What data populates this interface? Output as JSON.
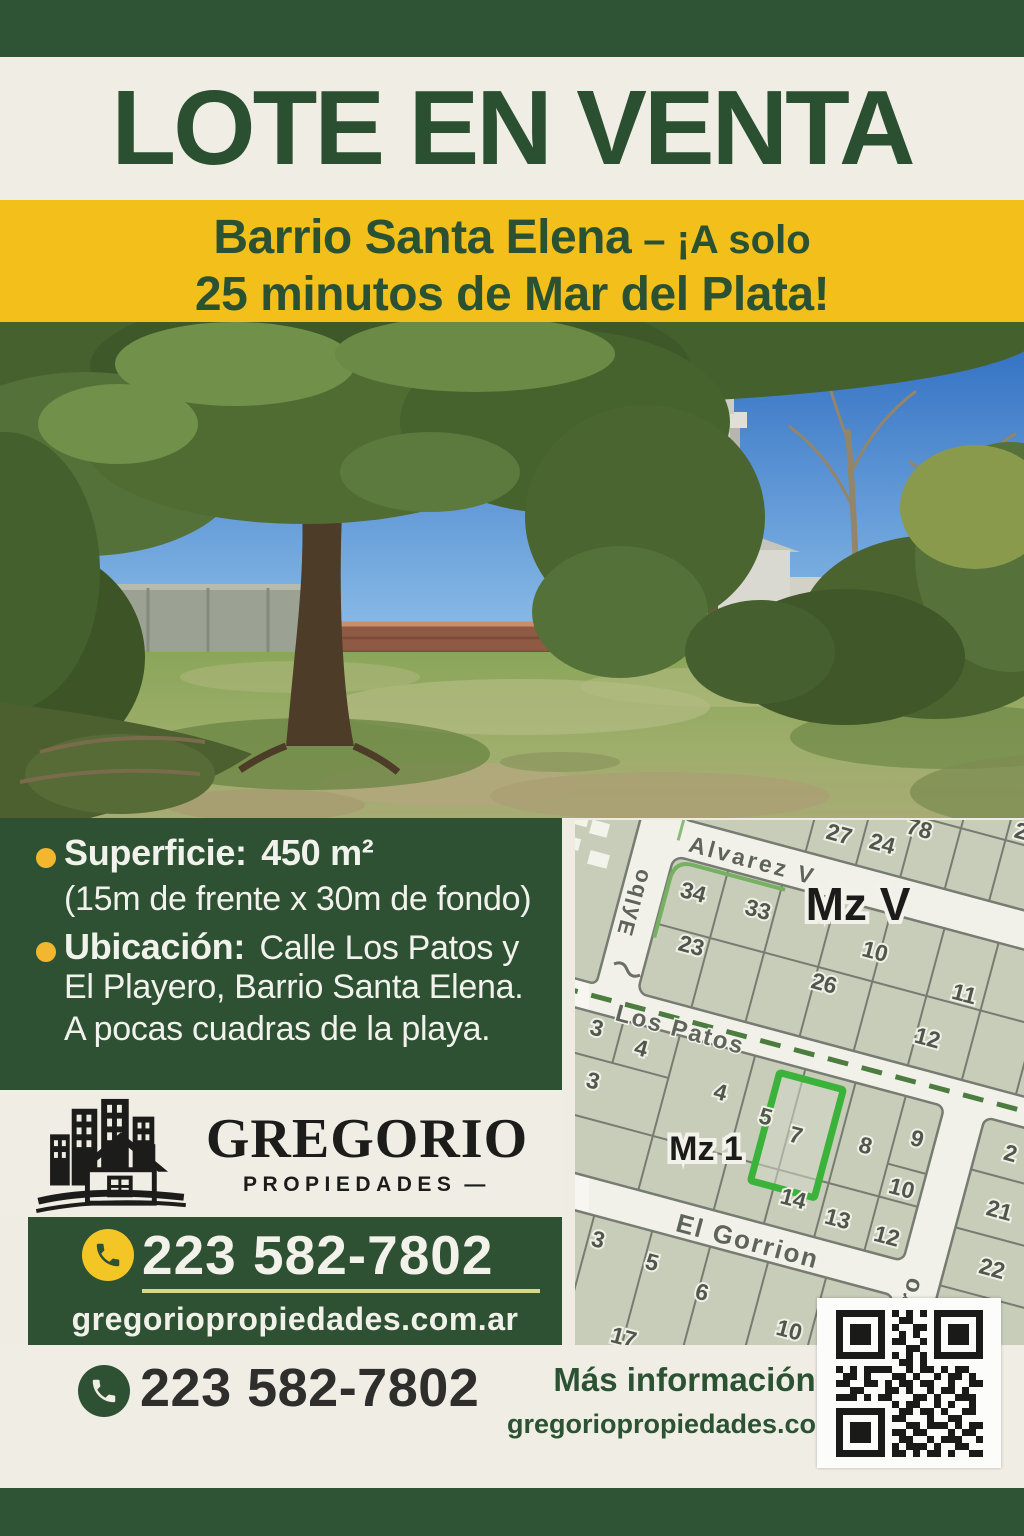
{
  "poster": {
    "title": "LOTE EN VENTA",
    "subtitle_strong": "Barrio Santa Elena",
    "subtitle_rest": "– ¡A solo",
    "subtitle_line2": "25 minutos de Mar del Plata!"
  },
  "details": {
    "surface_label": "Superficie:",
    "surface_value": "450 m²",
    "surface_note": "(15m de frente x 30m de fondo)",
    "location_label": "Ubicación:",
    "location_line1": "Calle Los Patos y",
    "location_line2": "El Playero, Barrio Santa Elena.",
    "location_line3": "A pocas cuadras de la playa."
  },
  "brand": {
    "name": "GREGORIO",
    "tagline": "PROPIEDADES",
    "tagline_dash": "—"
  },
  "contact": {
    "phone": "223 582-7802",
    "website": "gregoriopropiedades.com.ar",
    "more_info_label": "Más información:"
  },
  "map": {
    "block_labels": {
      "mz_v": "Mz V",
      "mz_1": "Mz 1"
    },
    "streets": {
      "alvarez": "Alvarez V",
      "los_patos": "Los Patos",
      "el_gorrion": "El Gorrion",
      "playero": "Playero",
      "left_street": "Ǝʎlbo"
    },
    "highlighted_lot": "7",
    "lots": {
      "n78": "78",
      "n27": "27",
      "n24": "24",
      "n2a": "2",
      "n34": "34",
      "n33": "33",
      "n23": "23",
      "n26": "26",
      "n10a": "10",
      "n11": "11",
      "n12a": "12",
      "n3a": "3",
      "n4a": "4",
      "n3b": "3",
      "n4b": "4",
      "n5a": "5",
      "n7": "7",
      "n8": "8",
      "n9": "9",
      "n14": "14",
      "n13": "13",
      "n12b": "12",
      "n10b": "10",
      "n2b": "2",
      "n21": "21",
      "n22": "22",
      "n3c": "3",
      "n5b": "5",
      "n6": "6",
      "n17": "17",
      "n10c": "10"
    }
  },
  "colors": {
    "dark_green": "#2e5134",
    "yellow": "#f2bf1b",
    "cream": "#efece3",
    "highlight_green": "#3bb33b",
    "logo_black": "#1c1c1a"
  }
}
